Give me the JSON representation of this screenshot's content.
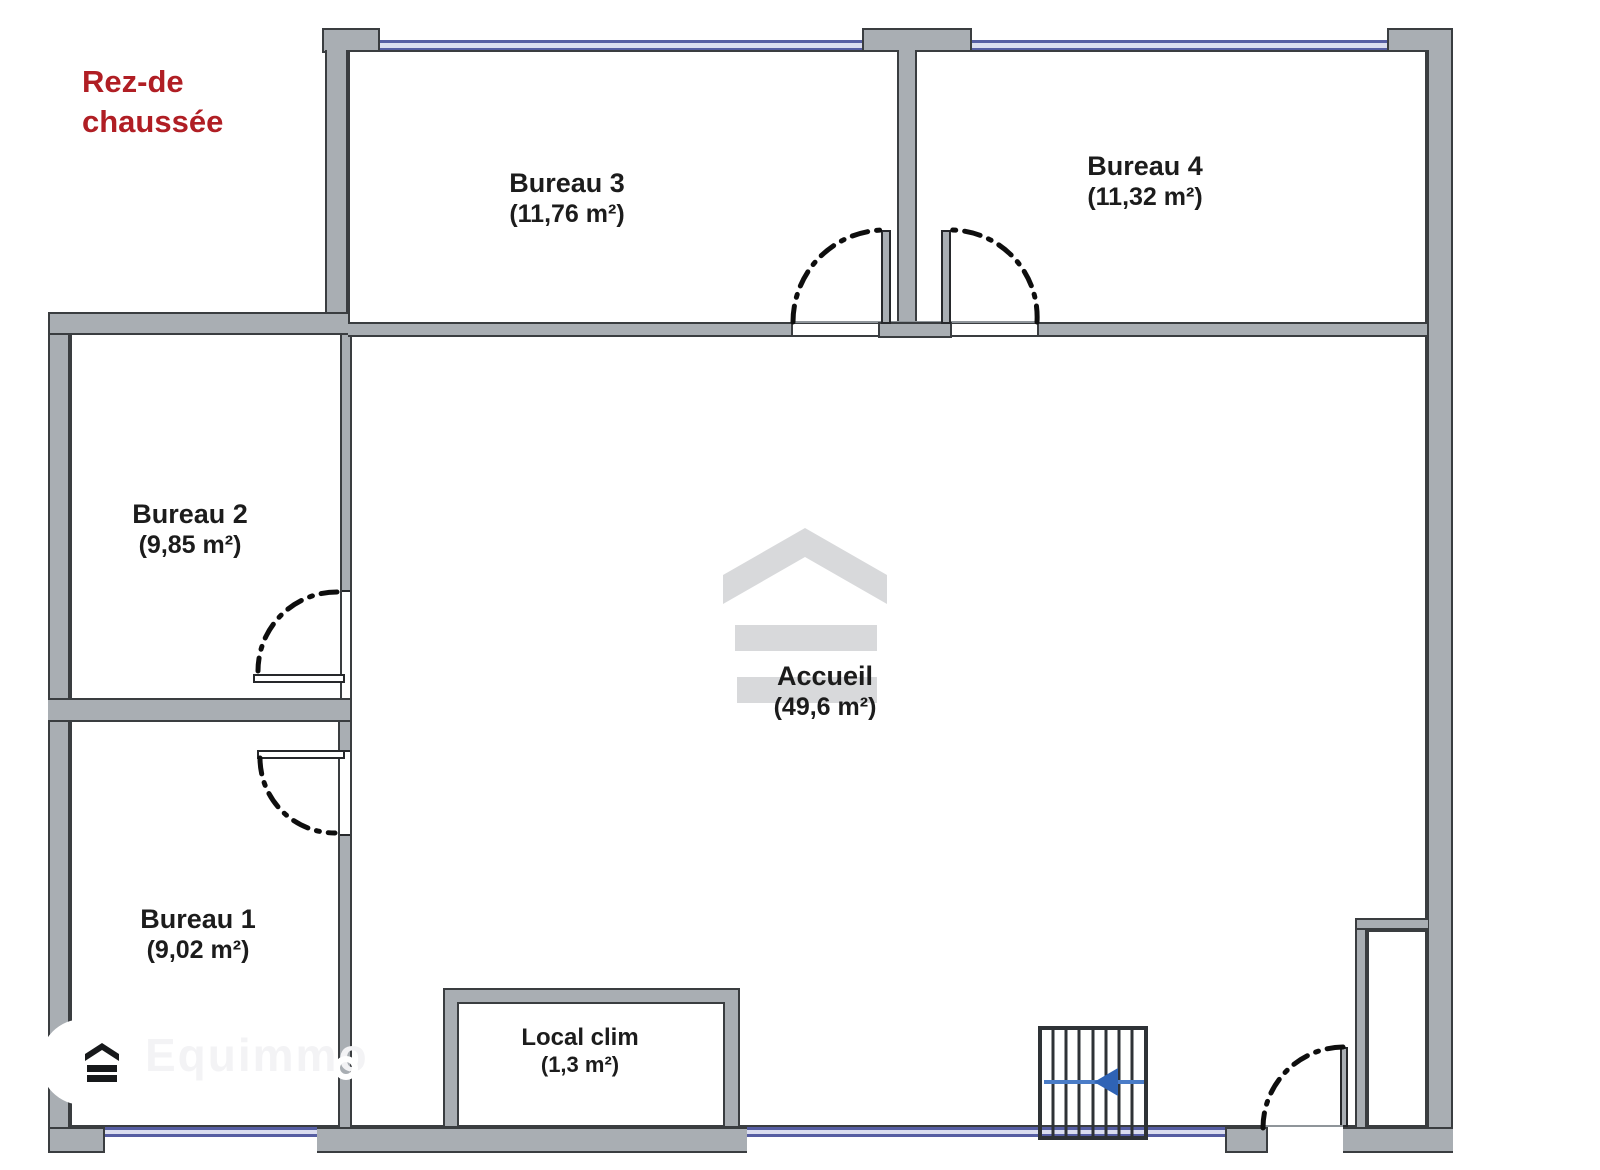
{
  "floor_plan": {
    "title_line1": "Rez-de",
    "title_line2": "chaussée",
    "rooms": [
      {
        "name": "Bureau 3",
        "area": "(11,76 m²)"
      },
      {
        "name": "Bureau 4",
        "area": "(11,32 m²)"
      },
      {
        "name": "Bureau 2",
        "area": "(9,85 m²)"
      },
      {
        "name": "Bureau 1",
        "area": "(9,02 m²)"
      },
      {
        "name": "Accueil",
        "area": "(49,6 m²)"
      },
      {
        "name": "Local clim",
        "area": "(1,3 m²)"
      }
    ],
    "watermark_text": "Equimmo",
    "icons": {
      "brand_logo": "chevron-roof-with-two-bars",
      "stairs_arrow": "left-arrow"
    },
    "stairs": {
      "direction": "left",
      "treads": 8
    },
    "colors": {
      "accent_red": "#B01E24",
      "wall_gray": "#A9AEB3",
      "wall_outline": "#3A3D40",
      "window_blue": "#565EA3",
      "stair_arrow_blue": "#2F63B5",
      "watermark_gray": "#D8D9DB"
    }
  }
}
